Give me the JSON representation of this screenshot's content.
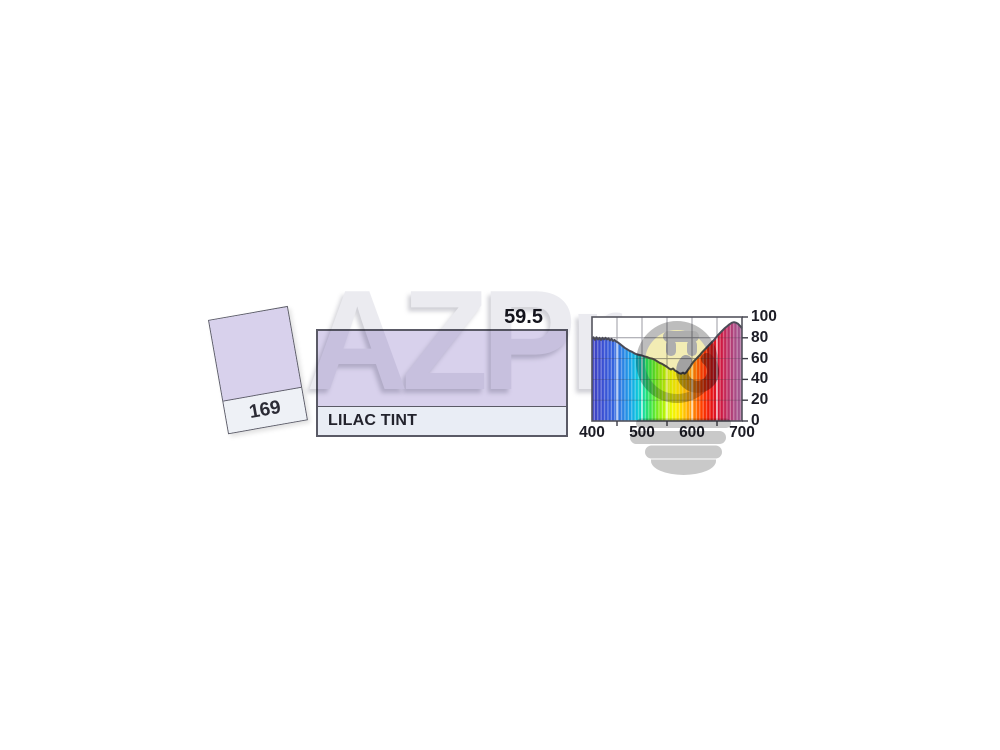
{
  "product": {
    "code": "169",
    "name": "LILAC TINT",
    "transmission_value": "59.5"
  },
  "watermark": {
    "text": "AZPr",
    "logo": "lightbulb-smiley-plug"
  },
  "colors": {
    "swatch_lilac": "#d8d1ec",
    "label_strip": "#e9edf5",
    "border": "#5a5a66",
    "curve_stroke": "#4b4b57",
    "grid": "#9b9ba3",
    "watermark_gray": "#ebebf0",
    "logo_face_yellow": "#f2ecb4",
    "logo_gray": "#b8b8b8"
  },
  "chart_data": {
    "type": "area",
    "title": "Spectral transmission curve",
    "xlabel": "Wavelength (nm)",
    "ylabel": "Transmission (%)",
    "xlim": [
      400,
      700
    ],
    "ylim": [
      0,
      100
    ],
    "x_ticks": [
      400,
      500,
      600,
      700
    ],
    "x_minor_ticks": [
      450,
      550,
      650
    ],
    "y_ticks": [
      0,
      20,
      40,
      60,
      80,
      100
    ],
    "grid": true,
    "legend": "none",
    "series": [
      {
        "name": "169 Lilac Tint transmission %",
        "x": [
          400,
          403,
          406,
          409,
          412,
          415,
          418,
          421,
          424,
          427,
          430,
          433,
          436,
          439,
          442,
          445,
          448,
          452,
          456,
          460,
          465,
          470,
          475,
          480,
          485,
          490,
          495,
          500,
          505,
          510,
          515,
          520,
          525,
          530,
          535,
          540,
          545,
          550,
          554,
          558,
          562,
          566,
          570,
          574,
          578,
          582,
          585,
          588,
          591,
          594,
          597,
          600,
          604,
          608,
          612,
          616,
          620,
          625,
          630,
          635,
          640,
          645,
          650,
          655,
          660,
          665,
          670,
          675,
          680,
          684,
          688,
          692,
          696,
          700
        ],
        "y": [
          79,
          80.5,
          78,
          80.5,
          78.5,
          80,
          78,
          80,
          78.5,
          80,
          78.5,
          79.5,
          77.5,
          79,
          77,
          78,
          76.5,
          75.5,
          74,
          72.5,
          70.5,
          69,
          67.5,
          66.5,
          65,
          64,
          63.5,
          63,
          62,
          61.5,
          60.5,
          60,
          59,
          57.5,
          56,
          55,
          53.5,
          52,
          50.5,
          49.5,
          50.5,
          48.5,
          47.5,
          46,
          45.5,
          46.5,
          45.5,
          46.5,
          48.5,
          50.5,
          52.5,
          55,
          57.5,
          59.5,
          61.5,
          63.5,
          66,
          68.5,
          71,
          73.5,
          76,
          78.5,
          81.5,
          84,
          86.5,
          89,
          91,
          93,
          94.5,
          95,
          94.5,
          93.5,
          91.5,
          89
        ]
      }
    ],
    "spectrum_stops": [
      {
        "nm": 400,
        "color": "#3f3fbe"
      },
      {
        "nm": 420,
        "color": "#3a4ed2"
      },
      {
        "nm": 440,
        "color": "#3560dd"
      },
      {
        "nm": 455,
        "color": "#2f76e2"
      },
      {
        "nm": 470,
        "color": "#2392e6"
      },
      {
        "nm": 480,
        "color": "#15ace6"
      },
      {
        "nm": 490,
        "color": "#0cc4dc"
      },
      {
        "nm": 498,
        "color": "#0cd4bc"
      },
      {
        "nm": 506,
        "color": "#1cde8c"
      },
      {
        "nm": 515,
        "color": "#33e354"
      },
      {
        "nm": 525,
        "color": "#5ce72e"
      },
      {
        "nm": 535,
        "color": "#8fee12"
      },
      {
        "nm": 548,
        "color": "#c4f404"
      },
      {
        "nm": 560,
        "color": "#eef600"
      },
      {
        "nm": 572,
        "color": "#fee800"
      },
      {
        "nm": 584,
        "color": "#ffc400"
      },
      {
        "nm": 596,
        "color": "#ff9c00"
      },
      {
        "nm": 608,
        "color": "#ff7000"
      },
      {
        "nm": 618,
        "color": "#ff4400"
      },
      {
        "nm": 628,
        "color": "#f62600"
      },
      {
        "nm": 638,
        "color": "#e81510"
      },
      {
        "nm": 648,
        "color": "#dc1226"
      },
      {
        "nm": 658,
        "color": "#d01840"
      },
      {
        "nm": 668,
        "color": "#c22a5c"
      },
      {
        "nm": 678,
        "color": "#b43c74"
      },
      {
        "nm": 688,
        "color": "#a94e88"
      },
      {
        "nm": 700,
        "color": "#a05a92"
      }
    ]
  }
}
